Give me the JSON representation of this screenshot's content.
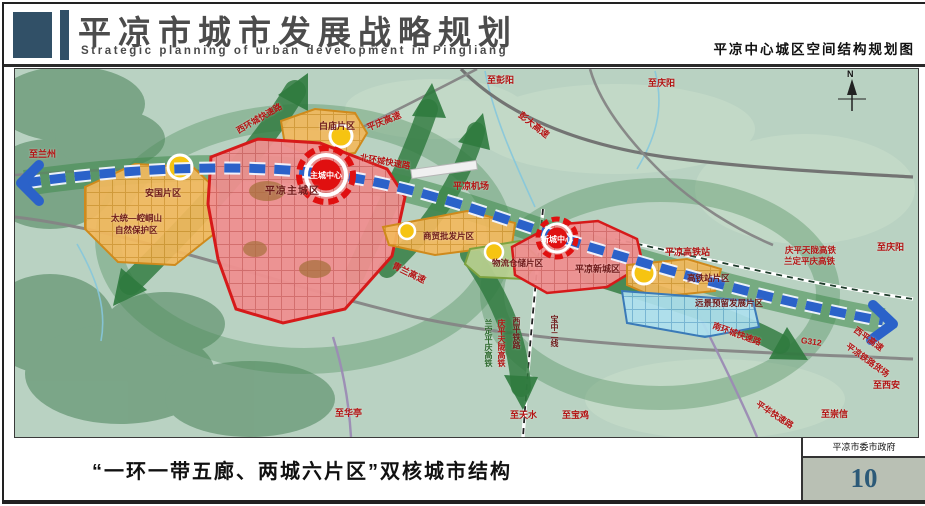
{
  "header": {
    "title": "平凉市城市发展战略规划",
    "subtitle": "Strategic planning of urban development in Pingliang",
    "map_title": "平凉中心城区空间结构规划图"
  },
  "footer": {
    "caption": "“一环一带五廊、两城六片区”双核城市结构",
    "organization": "平凉市委市政府",
    "page_number": "10"
  },
  "map": {
    "compass_label": "N",
    "labels": {
      "to_lanzhou": "至兰州",
      "to_pengyang": "至彭阳",
      "to_qingyang_top": "至庆阳",
      "pengda_expwy": "彭大高速",
      "pingqing_expwy": "平庆高速",
      "west_ring_road": "西环城快速路",
      "baimiao_district": "白庙片区",
      "north_ring_road": "北环城快速路",
      "main_city_center": "主城中心",
      "main_city": "平凉主城区",
      "anguo_district": "安国片区",
      "nature_reserve_1": "太统—崆峒山",
      "nature_reserve_2": "自然保护区",
      "airport": "平凉机场",
      "wholesale_district": "商贸批发片区",
      "qinglan_expwy": "青兰高速",
      "logistics_district": "物流仓储片区",
      "new_city_center": "新城中心",
      "new_city": "平凉新城区",
      "hsr_station": "平凉高铁站",
      "hsr_district": "高铁站片区",
      "future_district": "远景预留发展片区",
      "qingping_tianlong_hsr": "庆平天陇高铁",
      "landing_pingqing_hsr": "兰定平庆高铁",
      "to_qingyang_right": "至庆阳",
      "south_ring_road": "南环城快速路",
      "g312": "G312",
      "xiping_expwy": "西平高速",
      "rail_freight_yard": "平凉铁路货场",
      "to_xian": "至西安",
      "to_chongxin": "至崇信",
      "pinghua_expwy": "平华快速路",
      "to_huating": "至华亭",
      "to_tianshui": "至天水",
      "to_baoji": "至宝鸡",
      "landing_pingqing_hsr_v": "兰定平庆高铁",
      "qingping_tianlong_hsr_v": "庆平天陇高铁",
      "xiping_railway_v": "西平铁路",
      "baozhong_railway_v": "宝中二线"
    },
    "colors": {
      "accent_blue": "#315067",
      "axis_blue": "#2b62c9",
      "corridor_green": "#2f7a3e",
      "city_red": "#d61a1a",
      "district_orange": "#cf8a1c"
    }
  }
}
